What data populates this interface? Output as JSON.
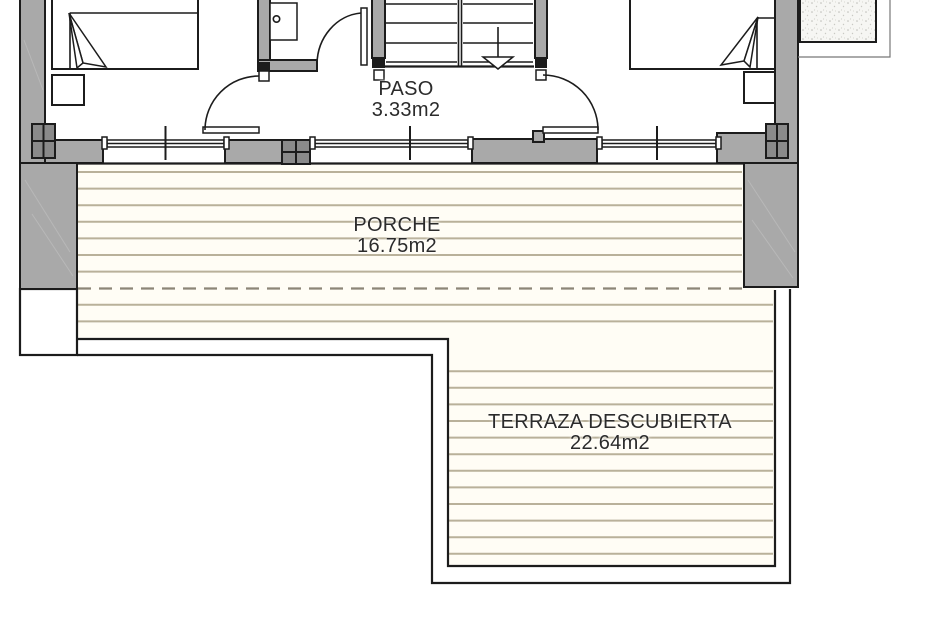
{
  "drawing": {
    "labels": {
      "paso": {
        "name": "PASO",
        "area": "3.33m2"
      },
      "porche": {
        "name": "PORCHE",
        "area": "16.75m2"
      },
      "terraza": {
        "name": "TERRAZA DESCUBIERTA",
        "area": "22.64m2"
      }
    },
    "colors": {
      "wall": "#a9a9a9",
      "column": "#8a8a8a",
      "line": "#1c1c1c",
      "deck_line": "#b9b19a",
      "deck_bg": "#fffdf5",
      "dash": "#8c8677",
      "text": "#2b2b2b",
      "paper": "#ffffff"
    }
  }
}
